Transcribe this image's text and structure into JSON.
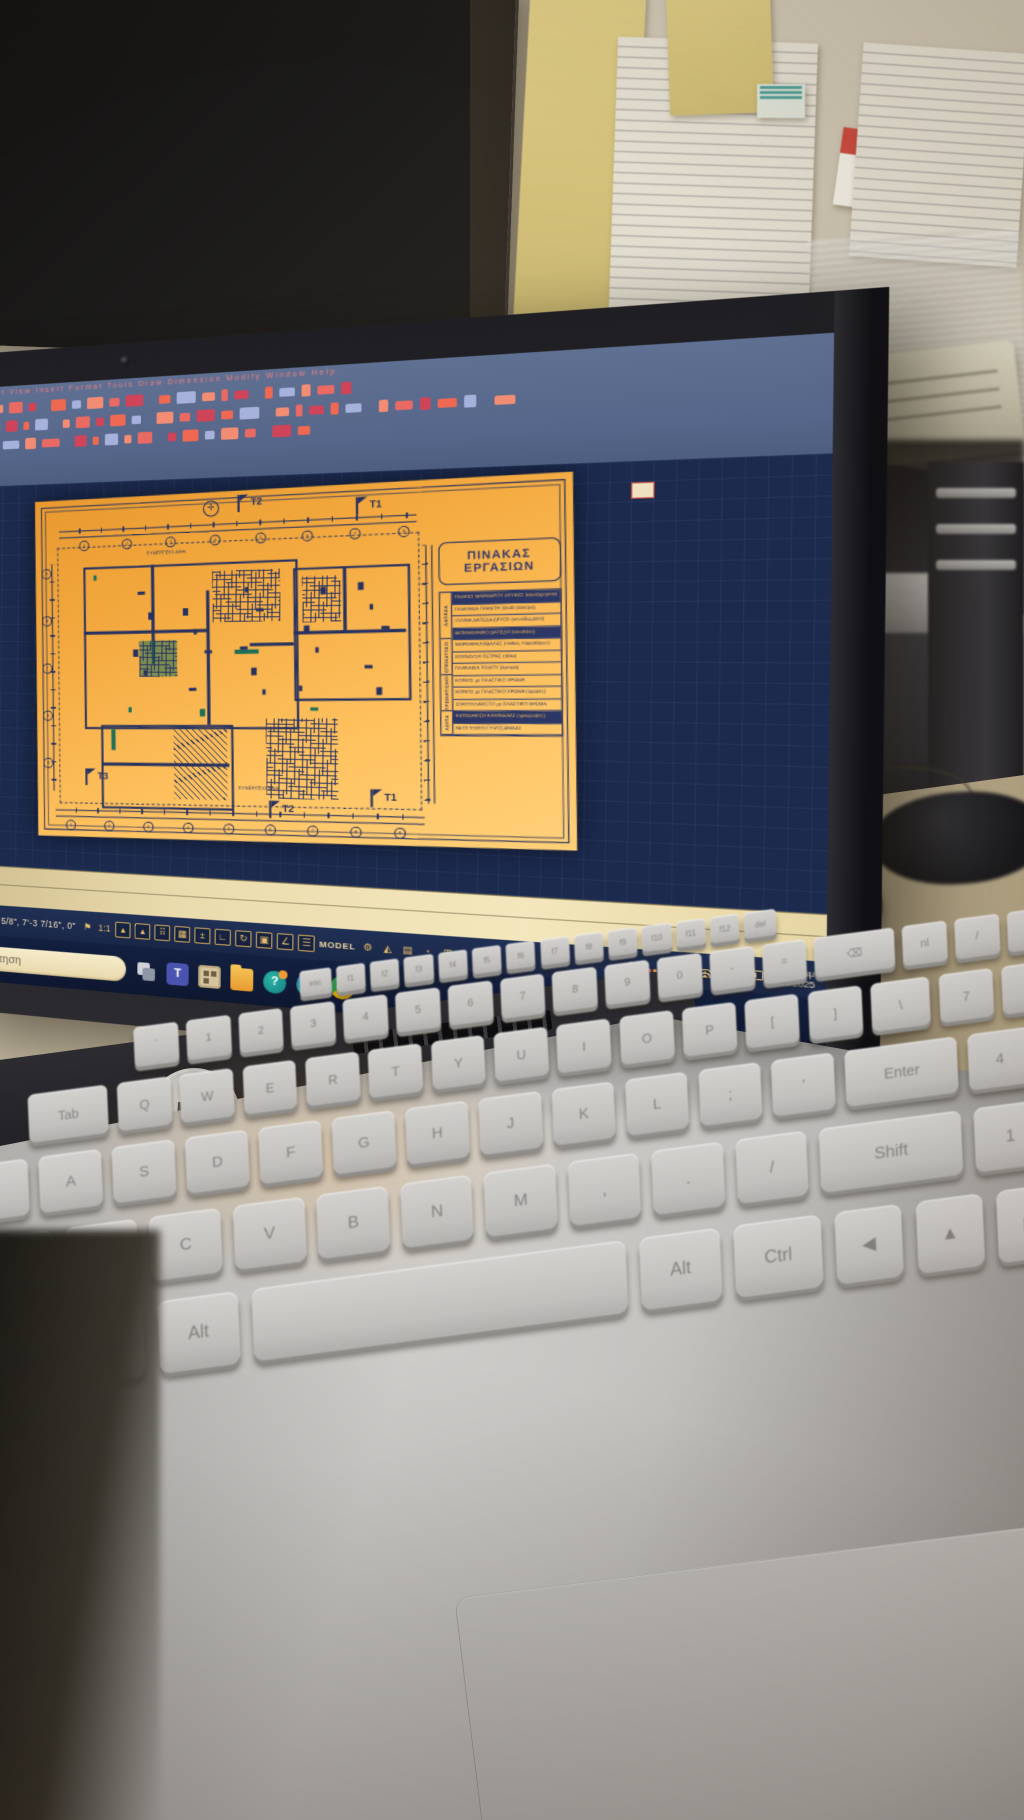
{
  "colors": {
    "accent_salmon": "#ee6852",
    "sheet_orange": "#f3a93f",
    "plan_navy": "#273260",
    "status_gold": "#e8bd6a",
    "taskbar_navy": "#0e1730",
    "cream": "#f4e7bd",
    "teal_accent": "#1e6e58"
  },
  "laptop": {
    "brand_logo": "hp",
    "screen": {
      "cad": {
        "menu_bar": "File   Edit   View   Insert   Format   Tools   Draw   Dimension   Modify   Window   Help",
        "toolbar_rows": [
          20,
          26,
          17
        ],
        "coordinates": "-11 5/8\", 7'-3 7/16\", 0\"",
        "status_icons": [
          {
            "name": "annotation-flag",
            "glyph": "⚑"
          },
          {
            "name": "annotation-scale",
            "text": "1:1"
          },
          {
            "name": "annotation-visibility",
            "glyph": "▴",
            "boxed": true
          },
          {
            "name": "annotation-autoscale",
            "glyph": "▴",
            "boxed": true
          },
          {
            "name": "snap-grid-dots",
            "glyph": "⠿",
            "boxed": true
          },
          {
            "name": "grid-display",
            "glyph": "▦",
            "boxed": true
          },
          {
            "name": "snap-mode",
            "glyph": "±",
            "boxed": true
          },
          {
            "name": "ortho-mode",
            "glyph": "∟",
            "boxed": true
          },
          {
            "name": "polar-tracking",
            "glyph": "↻",
            "boxed": true
          },
          {
            "name": "object-snap",
            "glyph": "▣",
            "boxed": true
          },
          {
            "name": "osnap-tracking",
            "glyph": "∠",
            "boxed": true
          },
          {
            "name": "lineweight",
            "glyph": "☰",
            "boxed": true
          },
          {
            "name": "model-space",
            "text": "MODEL"
          },
          {
            "name": "customization-gear",
            "glyph": "⚙"
          },
          {
            "name": "annotation-monitor",
            "glyph": "◭"
          },
          {
            "name": "quick-properties",
            "glyph": "▤"
          },
          {
            "name": "isolate-objects",
            "glyph": "◔"
          },
          {
            "name": "clean-screen",
            "glyph": "⊞"
          }
        ],
        "sheet": {
          "works_panel": {
            "title_line1": "ΠΙΝΑΚΑΣ",
            "title_line2": "ΕΡΓΑΣΙΩΝ",
            "groups": [
              {
                "label": "ΔΑΠΕΔΑ",
                "rows": 4
              },
              {
                "label": "ΕΠΕΝΔΥΣΕΙΣ",
                "rows": 3
              },
              {
                "label": "ΧΡΩΜΑΤΙΣΜΟΙ",
                "rows": 3
              },
              {
                "label": "ΛΟΙΠΑ",
                "rows": 2
              }
            ],
            "rows": [
              {
                "t": "ΠΛΑΚΕΣ ΜΑΡΜΑΡΟΥ ΛΕΥΚΕΣ (κοινόχρηστοι)",
                "dark": true
              },
              {
                "t": "ΠΛΑΚΑΚΙΑ ΓΡΑΝΙΤΗ 30x30 (λουτρά)",
                "dark": false
              },
              {
                "t": "ΞΥΛΙΝΑ ΔΑΠΕΔΑ ΔΡΥΟΣ (υπνοδωμάτια)",
                "dark": false
              },
              {
                "t": "ΒΙΟΜΗΧΑΝΙΚΟ ΔΑΠΕΔΟ (αποθήκη)",
                "dark": true
              },
              {
                "t": "ΜΑΡΜΑΡΑ ΚΑΒΑΛΑΣ (ποδιές παραθύρων)",
                "dark": false
              },
              {
                "t": "ΕΠΕΝΔΥΣΗ ΠΕΤΡΑΣ (τζάκι)",
                "dark": false
              },
              {
                "t": "ΠΛΑΚΑΚΙΑ ΤΟΙΧΟΥ (λουτρά)",
                "dark": false
              },
              {
                "t": "ΚΟΙΝΟΣ με ΠΛΑΣΤΙΚΟ ΧΡΩΜΑ",
                "dark": false
              },
              {
                "t": "ΚΟΙΝΟΣ με ΠΛΑΣΤΙΚΟ ΧΡΩΜΑ (οροφές)",
                "dark": false
              },
              {
                "t": "ΣΠΑΤΟΥΛΑΡΙΣΤΟ με ΠΛΑΣΤΙΚΟ ΧΡΩΜΑ",
                "dark": false
              },
              {
                "t": "ΚΑΤΕΔΑΦΙΣΗ ΚΑΜΙΝΑΔΑΣ (ημιώροφος)",
                "dark": true
              },
              {
                "t": "ΝΕΟΙ ΤΟΙΧΟΙ ΓΥΨΟΣΑΝΙΔΑΣ",
                "dark": false
              }
            ]
          },
          "flags": [
            {
              "label": "T2"
            },
            {
              "label": "T1"
            },
            {
              "label": "T3"
            },
            {
              "label": "T2"
            },
            {
              "label": "T1"
            }
          ],
          "labels": [
            {
              "t": "ΣΥΝΕΡΓΕΙΟ ΑΘΗ"
            },
            {
              "t": "ΣΥΝΕΡΓΕΙΟ ΑΘΗ"
            }
          ]
        }
      },
      "taskbar": {
        "search_placeholder": "Αναζήτηση",
        "icons": [
          {
            "name": "task-view",
            "label": ""
          },
          {
            "name": "teams",
            "label": "T"
          },
          {
            "name": "app-box",
            "label": ""
          },
          {
            "name": "file-explorer",
            "label": ""
          },
          {
            "name": "get-help",
            "label": "?"
          },
          {
            "name": "edge",
            "label": ""
          },
          {
            "name": "chrome",
            "label": ""
          }
        ],
        "tray": {
          "caret": "^",
          "language": "ΕΛ",
          "time": "1:25 μμ",
          "date": "6/10/2025"
        }
      }
    },
    "keyboard": {
      "rows": [
        [
          "esc",
          "f1",
          "f2",
          "f3",
          "f4",
          "f5",
          "f6",
          "f7",
          "f8",
          "f9",
          "f10",
          "f11",
          "f12",
          "del"
        ],
        [
          "`",
          "1",
          "2",
          "3",
          "4",
          "5",
          "6",
          "7",
          "8",
          "9",
          "0",
          "-",
          "=",
          "⌫",
          "nl",
          "/",
          "*"
        ],
        [
          "Tab",
          "Q",
          "W",
          "E",
          "R",
          "T",
          "Y",
          "U",
          "I",
          "O",
          "P",
          "[",
          "]",
          "\\",
          "7",
          "8",
          "9"
        ],
        [
          "Caps",
          "A",
          "S",
          "D",
          "F",
          "G",
          "H",
          "J",
          "K",
          "L",
          ";",
          "'",
          "Enter",
          "4",
          "5",
          "6"
        ],
        [
          "Shift",
          "Z",
          "X",
          "C",
          "V",
          "B",
          "N",
          "M",
          ",",
          ".",
          "/",
          "Shift",
          "1",
          "2",
          "3"
        ],
        [
          "Ctrl",
          "Fn",
          "⊞",
          "Alt",
          "",
          "Alt",
          "Ctrl",
          "◀",
          "▲",
          "▶",
          "0",
          "."
        ]
      ]
    }
  },
  "printer": {
    "brand_logo": "hp"
  }
}
